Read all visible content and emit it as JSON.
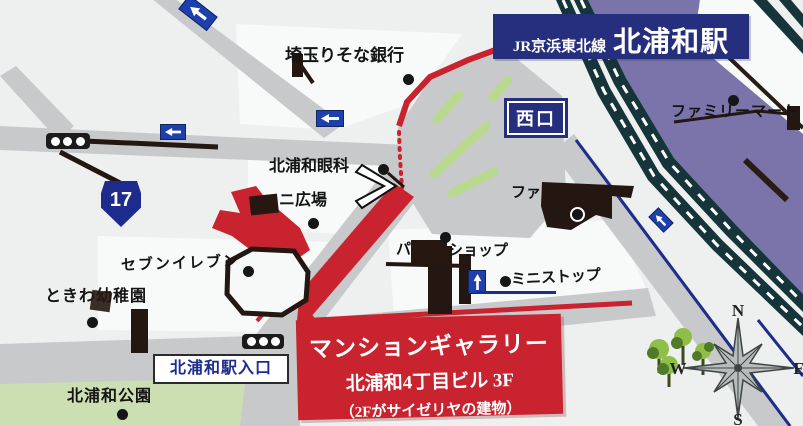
{
  "banner": {
    "line": "JR京浜東北線",
    "station": "北浦和駅"
  },
  "west_exit": "西口",
  "route_shield": "17",
  "labels": {
    "bank": "埼玉りそな銀行",
    "eye_clinic": "北浦和眼科",
    "plaza": "ニ広場",
    "family_mart_station": "ファ",
    "family_mart_ne": "ファミリーマート",
    "shop_prefix": "パ",
    "shop_suffix": "ショップ",
    "ministop": "ミニストップ",
    "seven_eleven": "セブンイレブン",
    "kindergarten": "ときわ幼稚園",
    "station_entrance": "北浦和駅入口",
    "park": "北浦和公園"
  },
  "destination_box": {
    "line1": "マンションギャラリー",
    "line2": "北浦和4丁目ビル 3F",
    "line3": "（2Fがサイゼリヤの建物）"
  },
  "compass": {
    "north": "N",
    "south": "S",
    "east": "E",
    "west": "W"
  },
  "colors": {
    "route_red": "#c8232e",
    "nav_navy": "#262e7e",
    "sign_blue": "#1e3fae",
    "rail_teal": "#16353b",
    "station_purple": "#7b74ab",
    "road_gray": "#c7c9cb",
    "park_green": "#cbdfb2",
    "stripe_green": "#b9d98f"
  }
}
